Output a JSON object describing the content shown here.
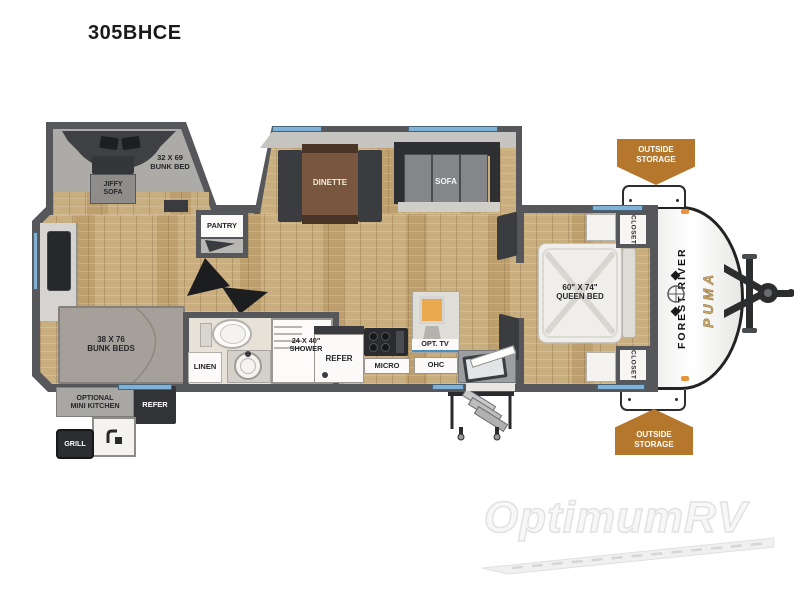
{
  "title": "305BHCE",
  "watermark": {
    "brand": "OptimumRV"
  },
  "colors": {
    "badge_orange": "#B5772C",
    "window_blue": "#7FB2D6",
    "wall_gray": "#55575A",
    "floor_tan": "#C9AE80",
    "brand_tan": "#C9A86D"
  },
  "floorplan": {
    "bunk_room": {
      "bunk_bed": "32 X 69\nBUNK BED",
      "jiffy_sofa": "JIFFY\nSOFA"
    },
    "living": {
      "dinette": "DINETTE",
      "sofa": "SOFA"
    },
    "pantry": "PANTRY",
    "bunkhouse": {
      "bunk_beds": "38 X 76\nBUNK BEDS"
    },
    "bathroom": {
      "linen": "LINEN",
      "shower": "24 X 40\"\nSHOWER"
    },
    "kitchen": {
      "refer": "REFER",
      "micro": "MICRO",
      "opt_tv": "OPT. TV",
      "ohc": "OHC"
    },
    "bedroom": {
      "queen_bed": "60\" X 74\"\nQUEEN BED",
      "closet_top": "CLOSET",
      "closet_bottom": "CLOSET"
    },
    "exterior": {
      "outside_storage_top": "OUTSIDE\nSTORAGE",
      "outside_storage_bottom": "OUTSIDE\nSTORAGE",
      "brand_primary": "FOREST RIVER",
      "brand_model": "PUMA"
    },
    "outdoor_kitchen": {
      "label": "OPTIONAL\nMINI KITCHEN",
      "refer": "REFER",
      "grill": "GRILL"
    }
  }
}
